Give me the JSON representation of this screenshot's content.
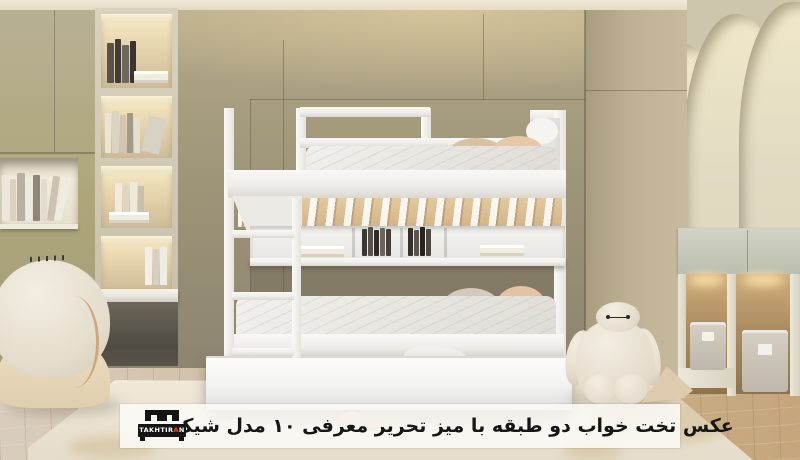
{
  "caption": {
    "text": "عکس تخت خواب دو طبقه با میز تحریر معرفی ۱۰ مدل شیک",
    "text_color": "#161616",
    "bar_background": "rgba(251,250,247,0.87)"
  },
  "logo": {
    "brand_prefix": "TAKHTIR",
    "brand_accent_letter": "A",
    "brand_suffix": "N",
    "accent_color": "#e8500f",
    "background_color": "#141414"
  },
  "scene": {
    "objects": [
      "white-bunk-bed",
      "ladder",
      "trundle-drawer",
      "under-bunk-bookshelf",
      "lit-bookshelf-column",
      "floating-desk",
      "plush-armchair",
      "baymax-plush",
      "fabric-storage-boxes",
      "arched-niche-wall",
      "wood-floor",
      "cream-rug",
      "slippers"
    ],
    "palette": {
      "wall_olive": "#9c937a",
      "cabinet_olive": "#b3ab8e",
      "arch_wall": "#e3dcc2",
      "bed_white": "#f4f3f1",
      "slat_wood": "#ddc298",
      "floor_wood": "#c9a982",
      "rug": "#ece5d6",
      "pillow_beige": "#d9c2a2",
      "pillow_peach": "#e6c8a6",
      "led_glow": "#f7dda6"
    }
  }
}
